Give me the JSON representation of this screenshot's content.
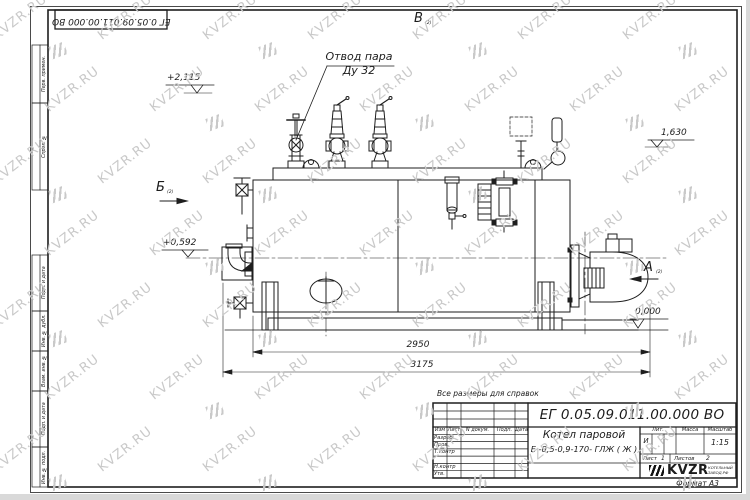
{
  "watermark": {
    "text": "KVZR.RU",
    "color": "#c9c9c9"
  },
  "corner_stamp": {
    "number": "ЕГ 0.05.09.011.00.000  ВО"
  },
  "side_strip": {
    "labels": [
      "Перв. примен.",
      "Справ. №",
      "Подп. и дата",
      "Инв. № дубл.",
      "Взам. инв. №",
      "Подп. и дата",
      "Инв. № подл."
    ]
  },
  "drawing": {
    "callout_line1": "Отвод пара",
    "callout_line2": "Ду 32",
    "elev_top": "+2,115",
    "elev_right": "1,630",
    "elev_left": "+0,592",
    "elev_zero": "0,000",
    "dim_inner": "2950",
    "dim_outer": "3175",
    "view_b": "Б",
    "view_a": "А",
    "view_v": "В",
    "view_ref": "(2)"
  },
  "titleblock": {
    "note": "Все размеры для справок",
    "doc_number": "ЕГ 0.05.09.011.00.000  ВО",
    "product_line1": "Котел паровой",
    "product_line2": "Е -0,5-0,9-170- ГЛЖ ( Ж )",
    "header_cols": [
      "Изм",
      "Лист",
      "N докум.",
      "Подп.",
      "Дата"
    ],
    "sig_labels": [
      "Разраб.",
      "Пров.",
      "Т.контр",
      "",
      "Н.контр",
      "Утв."
    ],
    "lit_label": "Лит.",
    "mass_label": "Масса",
    "scale_label": "Масштаб",
    "lit_value": "И",
    "scale_value": "1:15",
    "sheet_label": "Лист",
    "sheet_num": "1",
    "sheets_label": "Листов",
    "sheets_num": "2",
    "logo_text": "KVZR",
    "logo_sub1": "КОТЕЛЬНЫЙ",
    "logo_sub2": "ЗАВОД.РФ",
    "format_note": "Формат А3"
  }
}
